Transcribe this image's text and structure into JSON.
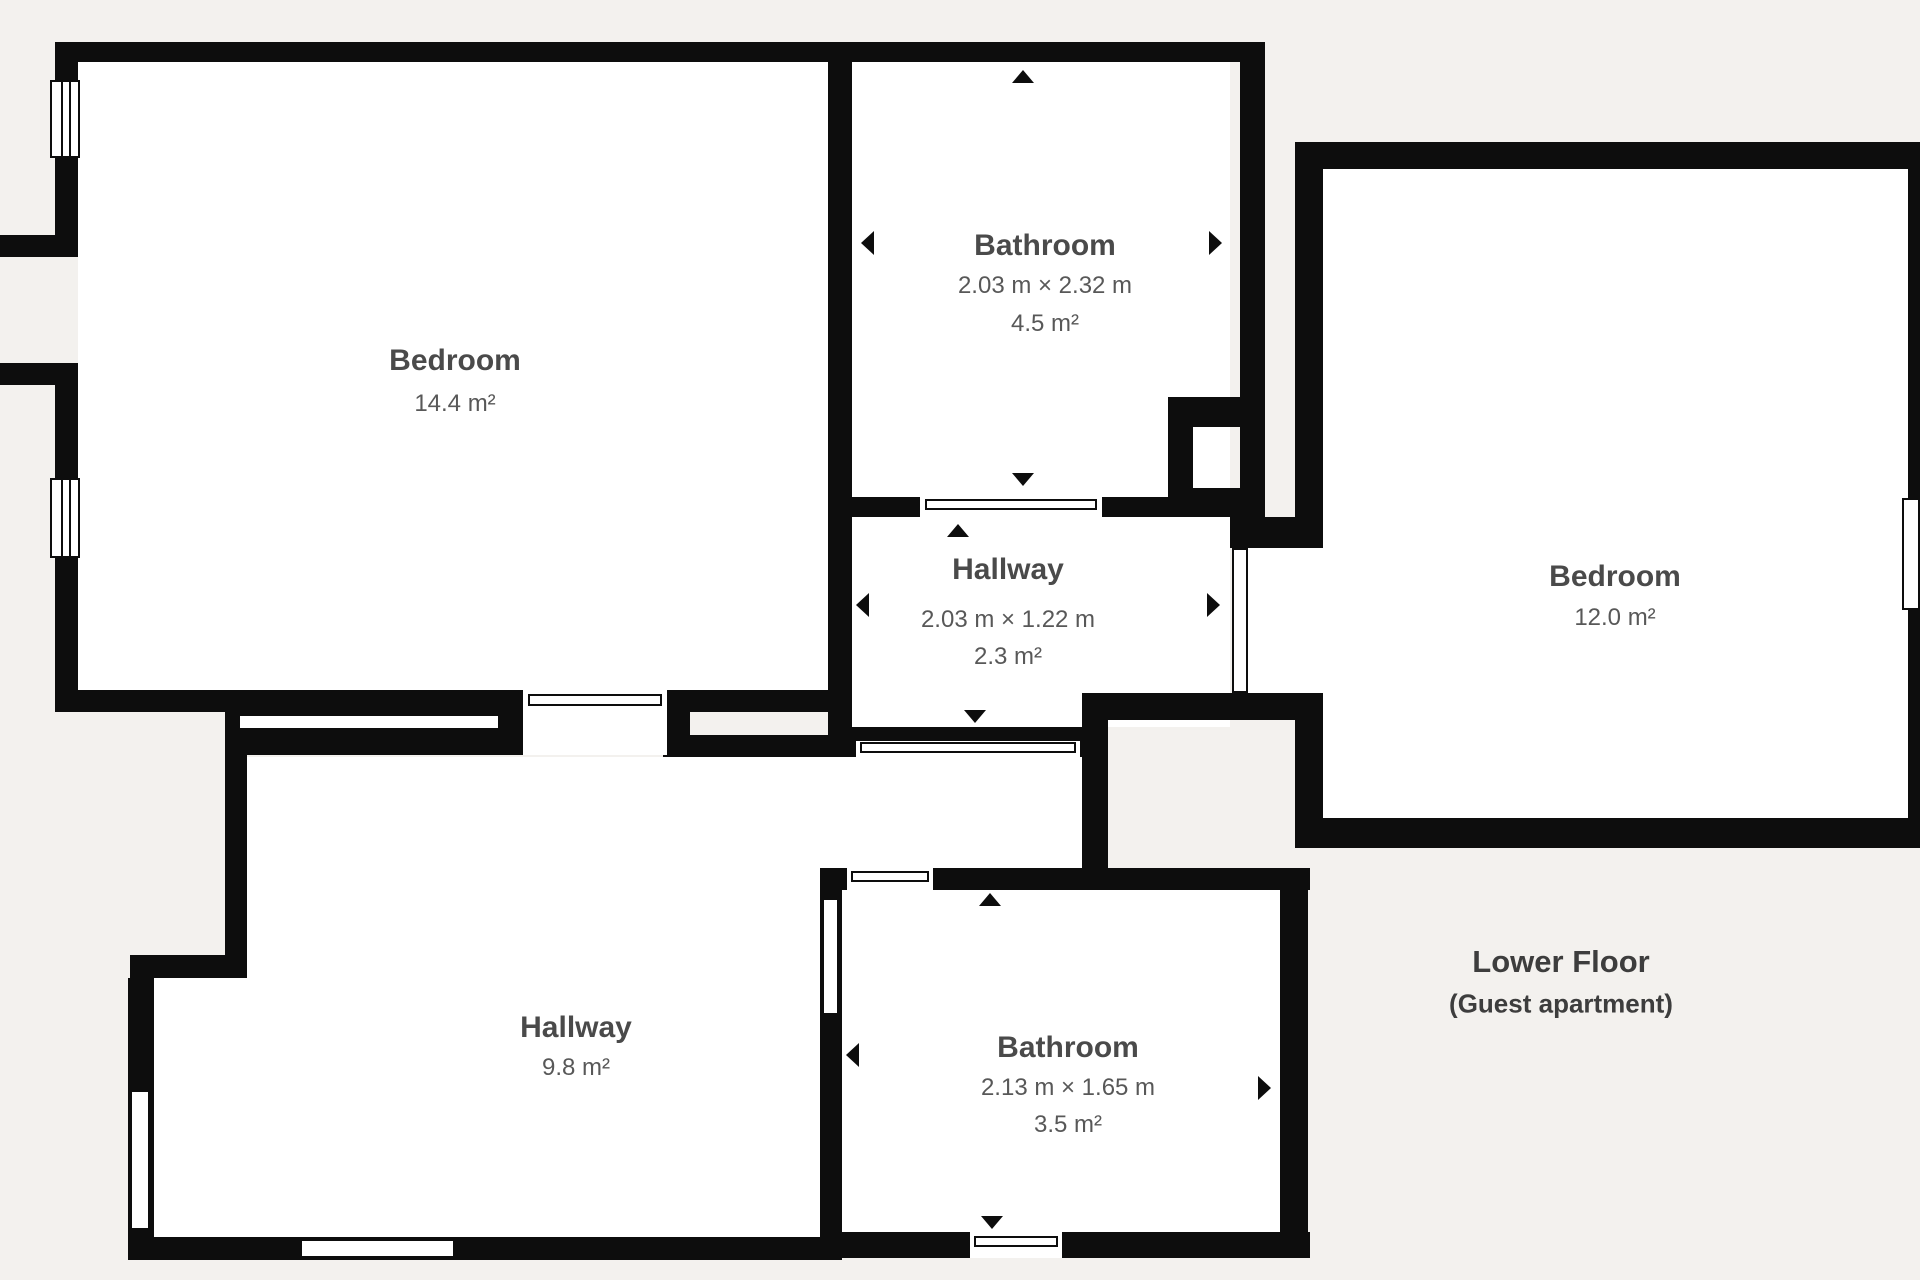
{
  "colors": {
    "background": "#f3f1ee",
    "wall": "#0d0d0d",
    "room_fill": "#ffffff",
    "label_title": "#4a4a4a",
    "label_sub": "#585858"
  },
  "rooms": {
    "bedroom1": {
      "name": "Bedroom",
      "area": "14.4 m²"
    },
    "bathroom1": {
      "name": "Bathroom",
      "dimensions": "2.03 m × 2.32 m",
      "area": "4.5 m²"
    },
    "hallway1": {
      "name": "Hallway",
      "dimensions": "2.03 m × 1.22 m",
      "area": "2.3 m²"
    },
    "bedroom2": {
      "name": "Bedroom",
      "area": "12.0 m²"
    },
    "hallway2": {
      "name": "Hallway",
      "area": "9.8 m²"
    },
    "bathroom2": {
      "name": "Bathroom",
      "dimensions": "2.13 m × 1.65 m",
      "area": "3.5 m²"
    }
  },
  "floor_label": {
    "title": "Lower Floor",
    "subtitle": "(Guest apartment)"
  }
}
